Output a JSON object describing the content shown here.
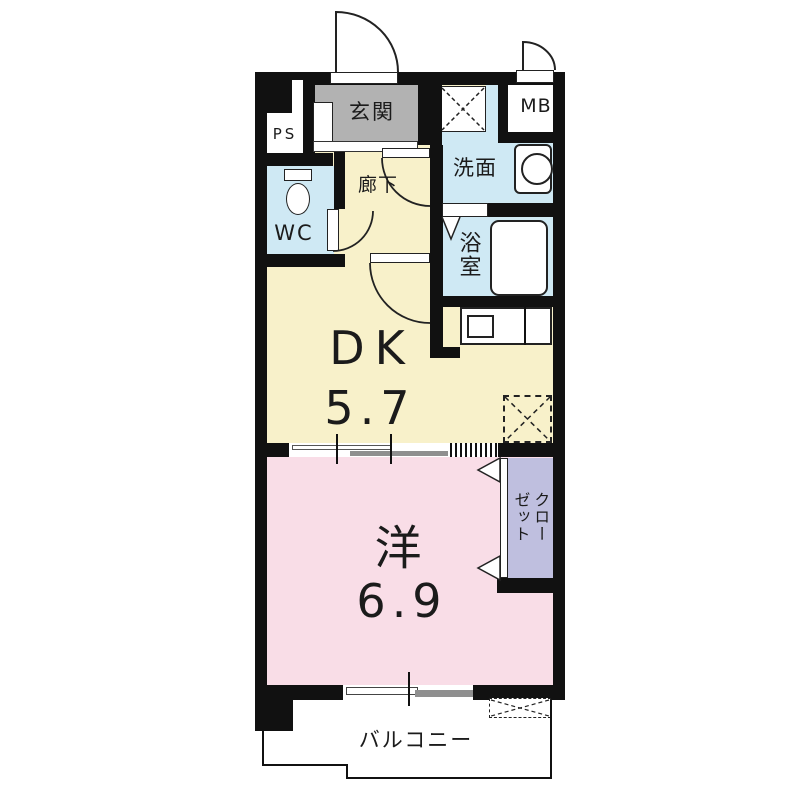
{
  "plan": {
    "type": "apartment-floorplan-1DK",
    "rooms": {
      "entrance": {
        "label": "玄関"
      },
      "pipe_space": {
        "label": "PS"
      },
      "hallway": {
        "label": "廊下"
      },
      "toilet": {
        "label": "WC"
      },
      "washroom": {
        "label": "洗面"
      },
      "bathroom": {
        "label": "浴室"
      },
      "meter_box": {
        "label": "MB"
      },
      "dining_kitchen": {
        "label": "DK",
        "size": "5.7"
      },
      "western_room": {
        "label": "洋",
        "size": "6.9"
      },
      "closet": {
        "label": "クローゼット",
        "column_right": "クロー",
        "column_left": "ゼット"
      },
      "balcony": {
        "label": "バルコニー"
      }
    },
    "colors": {
      "wall": "#111111",
      "dk_floor": "#f8f1ca",
      "western_floor": "#f9dde7",
      "wet_area": "#cfe9f4",
      "closet_fill": "#bfbfdf",
      "entrance_fill": "#b2b2b2",
      "sliding_door": "#8f8f8f"
    }
  }
}
